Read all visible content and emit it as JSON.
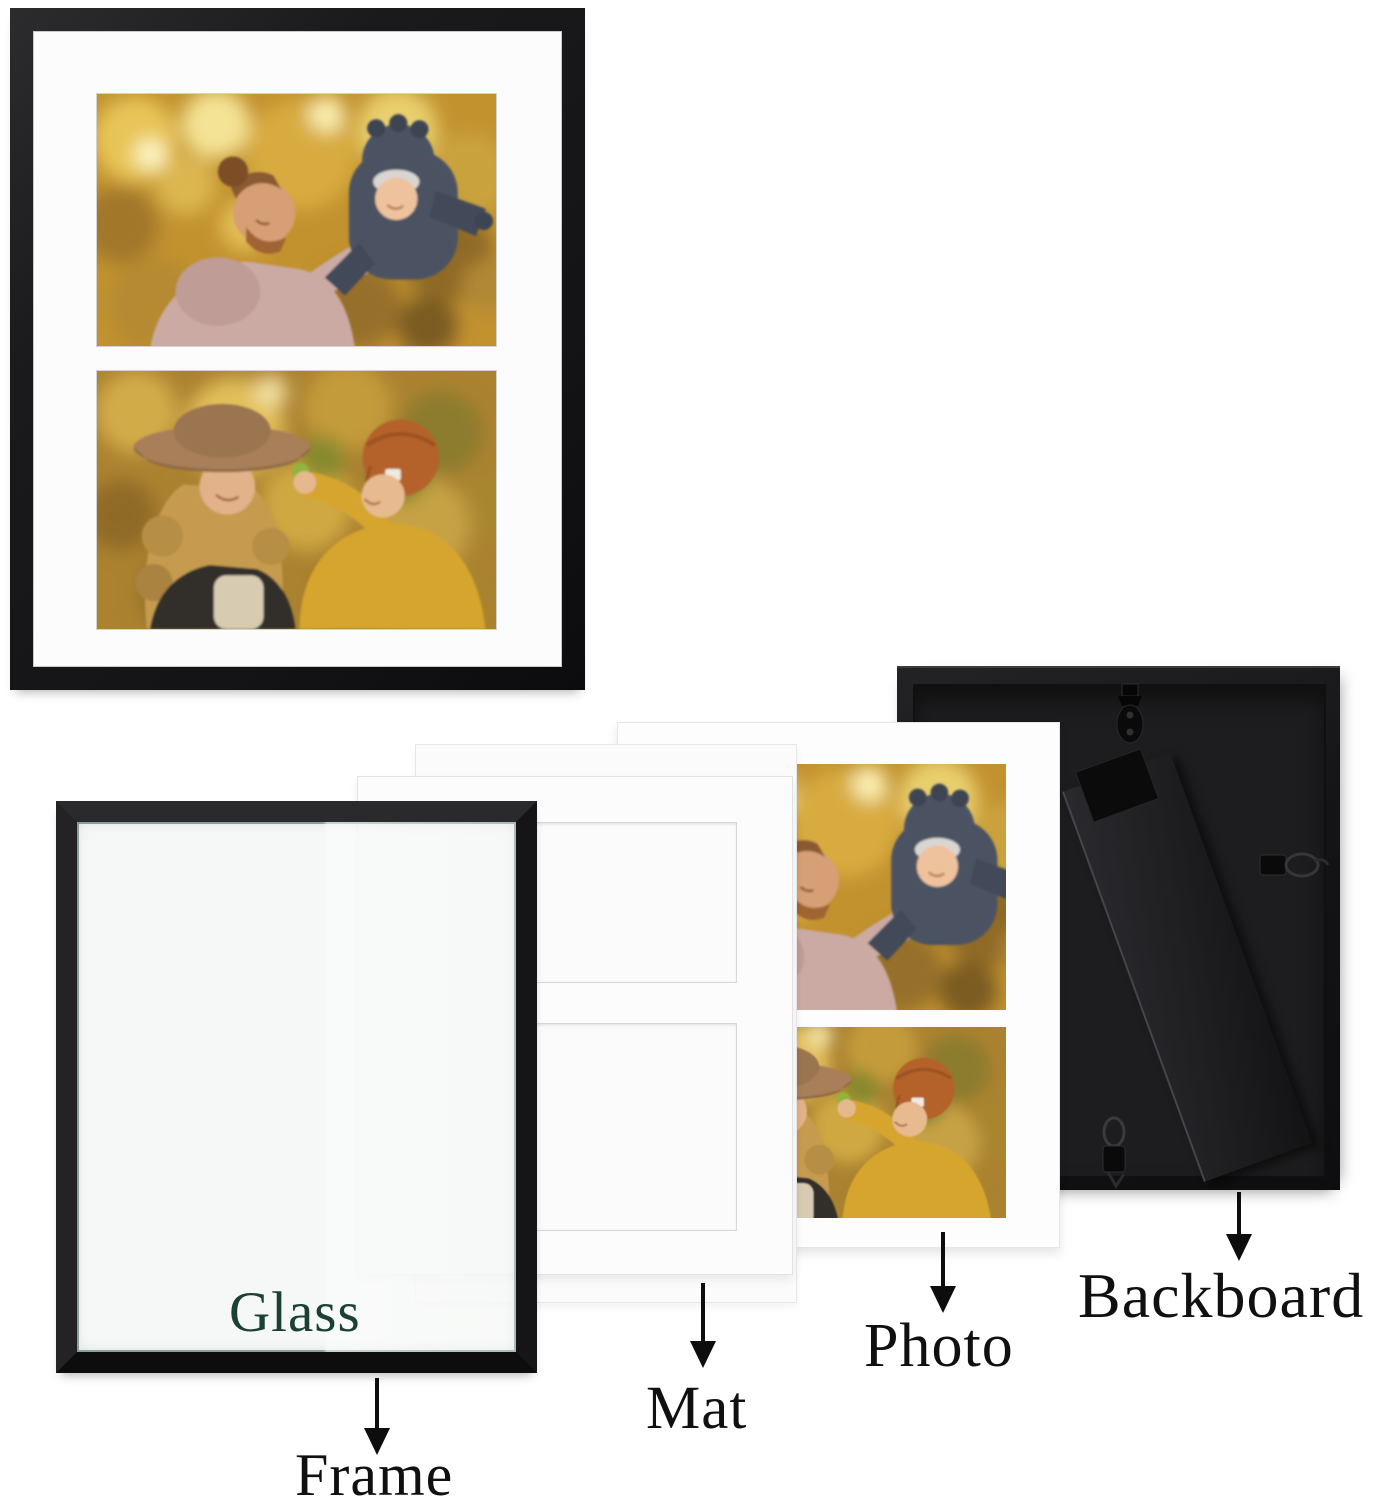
{
  "diagram": {
    "kind": "picture-frame-parts-exploded-view",
    "parts": [
      {
        "id": "frame",
        "label": "Frame"
      },
      {
        "id": "glass",
        "label": "Glass"
      },
      {
        "id": "mat",
        "label": "Mat"
      },
      {
        "id": "photo",
        "label": "Photo"
      },
      {
        "id": "backboard",
        "label": "Backboard"
      }
    ]
  },
  "labels": {
    "glass": "Glass",
    "frame": "Frame",
    "mat": "Mat",
    "photo": "Photo",
    "backboard": "Backboard"
  },
  "colors": {
    "frame_black": "#1a1a1c",
    "backboard_black": "#1d1d1f",
    "mat_white": "#fcfcfd",
    "photo_sheet_white": "#fdfdfe",
    "glass_tint": "#f3f5f4",
    "glass_label_green": "#1c4134",
    "label_text": "#101010",
    "autumn_gold": "#c2922f"
  },
  "icons": {
    "arrow_down": "solid black down arrow",
    "sawtooth_hanger": "black hanging bracket with oval plate and screws",
    "d_ring_hanger": "black d-ring with spring clip",
    "easel_stand": "black diagonal kickstand bar"
  }
}
